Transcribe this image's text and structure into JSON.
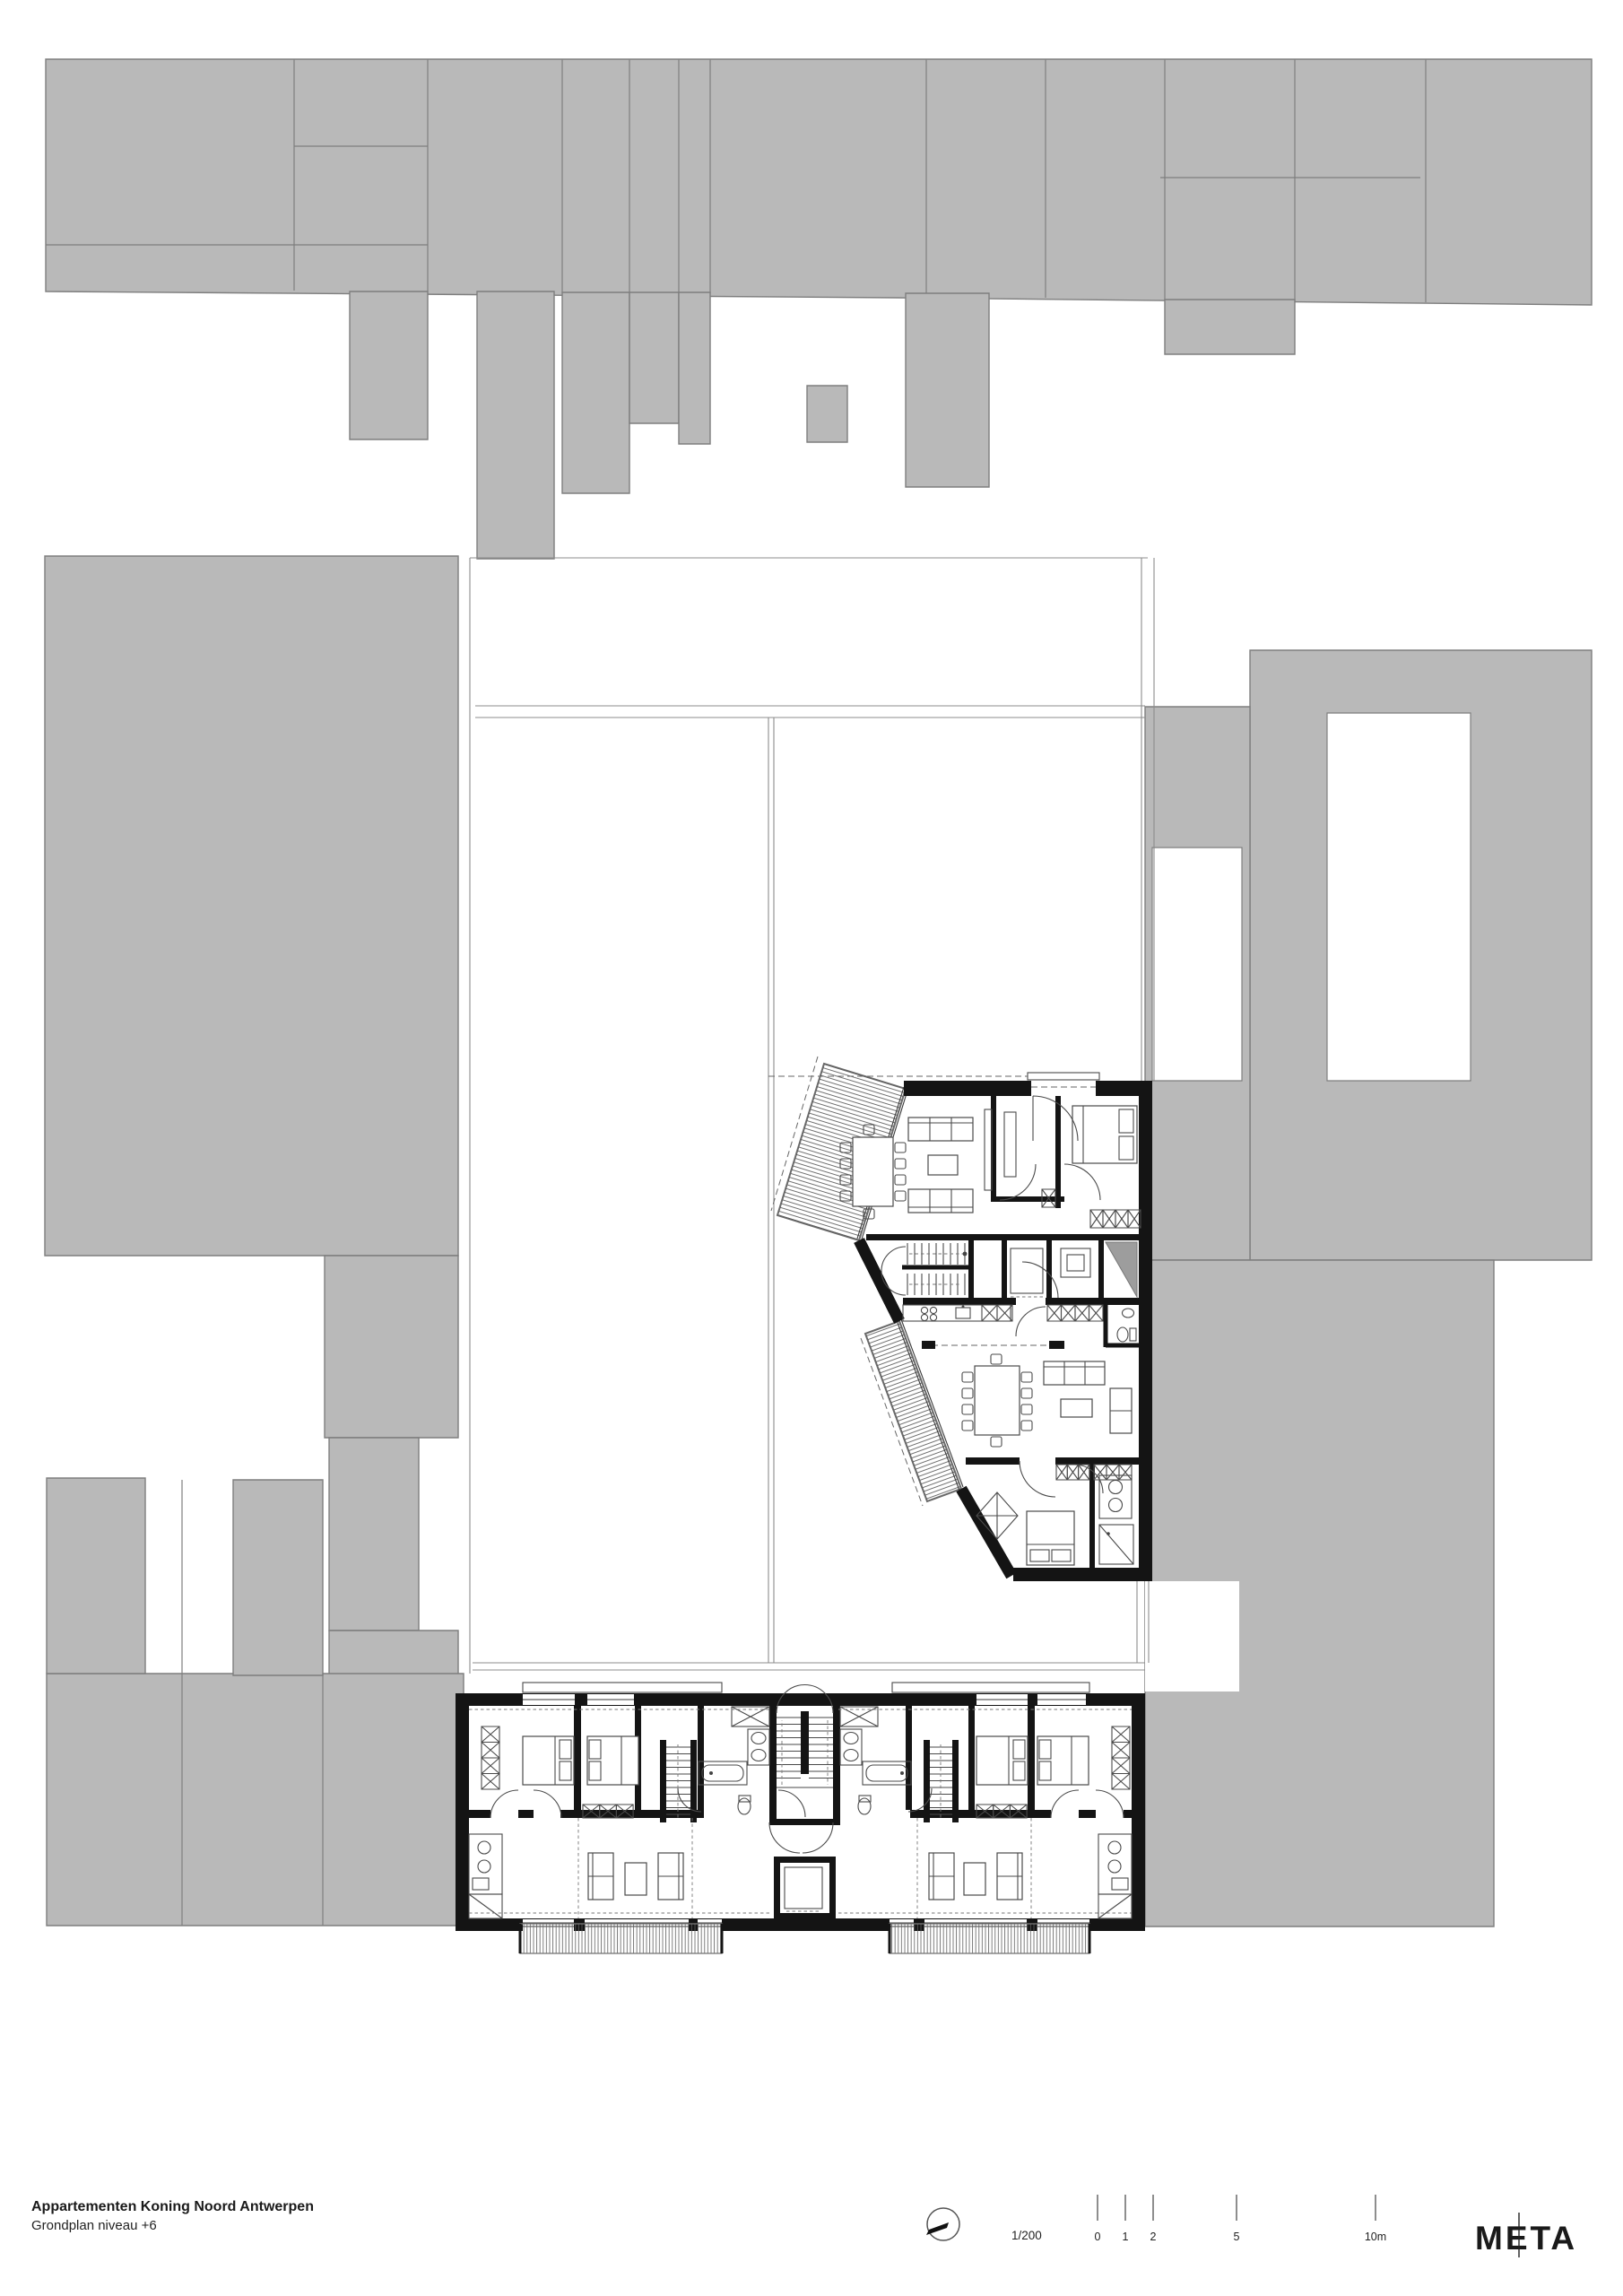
{
  "document": {
    "title": "Appartementen Koning Noord Antwerpen",
    "subtitle": "Grondplan niveau +6"
  },
  "scale": {
    "ratio_label": "1/200",
    "bar_ticks": [
      {
        "label": "0"
      },
      {
        "label": "1"
      },
      {
        "label": "2"
      },
      {
        "label": "5"
      },
      {
        "label": "10m"
      }
    ]
  },
  "logo": {
    "text": "META"
  },
  "icons": {
    "north_arrow": "compass-circle-with-needle"
  },
  "colors": {
    "building_fill": "#b9b9b9",
    "building_stroke": "#7e7e7e",
    "wall": "#141414",
    "thin": "#8c8c8c",
    "furn": "#4a4a4a",
    "page": "#ffffff"
  }
}
